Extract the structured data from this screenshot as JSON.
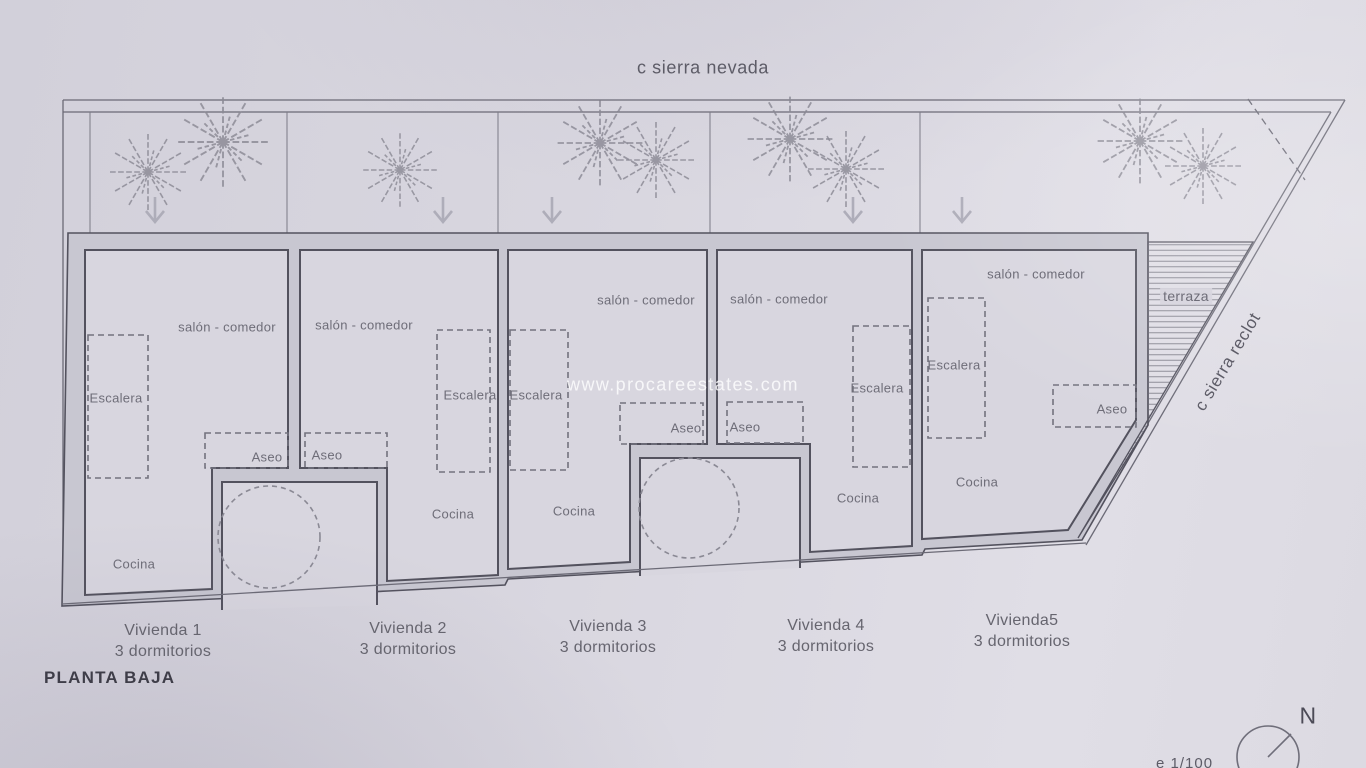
{
  "plan": {
    "street_top": "c sierra nevada",
    "street_right": "c sierra reclot",
    "watermark": "www.procareestates.com",
    "floor_title": "PLANTA BAJA",
    "terrace": "terraza",
    "compass": "N",
    "scale_note": "e 1/100",
    "units": [
      {
        "name": "Vivienda 1",
        "bedrooms": "3 dormitorios",
        "rooms": {
          "salon": "salón - comedor",
          "escalera": "Escalera",
          "aseo": "Aseo",
          "cocina": "Cocina"
        }
      },
      {
        "name": "Vivienda 2",
        "bedrooms": "3 dormitorios",
        "rooms": {
          "salon": "salón - comedor",
          "escalera": "Escalera",
          "aseo": "Aseo",
          "cocina": "Cocina"
        }
      },
      {
        "name": "Vivienda 3",
        "bedrooms": "3 dormitorios",
        "rooms": {
          "salon": "salón - comedor",
          "escalera": "Escalera",
          "aseo": "Aseo",
          "cocina": "Cocina"
        }
      },
      {
        "name": "Vivienda 4",
        "bedrooms": "3 dormitorios",
        "rooms": {
          "salon": "salón - comedor",
          "escalera": "Escalera",
          "aseo": "Aseo",
          "cocina": "Cocina"
        }
      },
      {
        "name": "Vivienda5",
        "bedrooms": "3 dormitorios",
        "rooms": {
          "salon": "salón - comedor",
          "escalera": "Escalera",
          "aseo": "Aseo",
          "cocina": "Cocina"
        }
      }
    ]
  },
  "colors": {
    "paper": "#d8d6df",
    "wall_fill": "#c8c7d1",
    "line_dark": "#53525e",
    "line_thin": "#6b6a76",
    "label": "#6e6d78",
    "hatch": "#8a8994",
    "tree": "#8b8a95",
    "arrow": "#aeadb9"
  }
}
